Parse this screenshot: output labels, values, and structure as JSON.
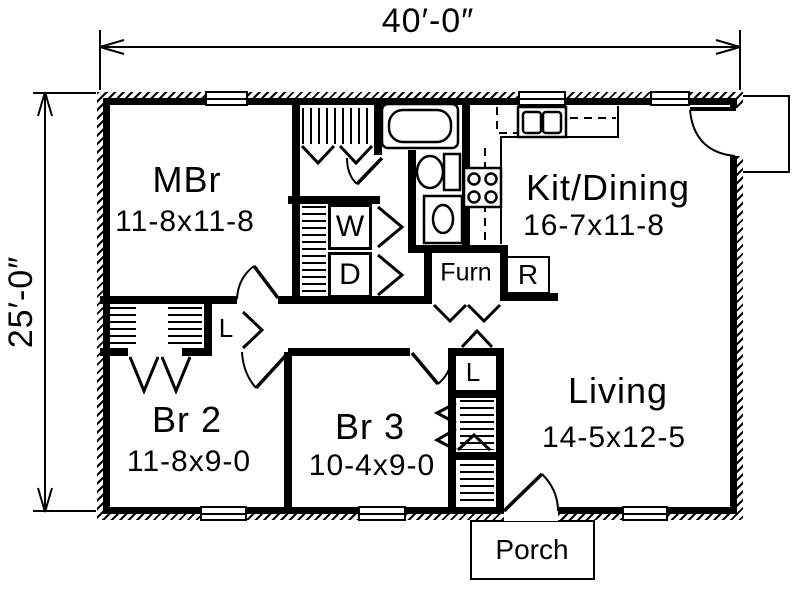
{
  "title": "One-story house floor plan",
  "dimensions": {
    "width_label": "40′-0″",
    "height_label": "25′-0″"
  },
  "rooms": [
    {
      "name": "MBr",
      "size": "11-8x11-8"
    },
    {
      "name": "Kit/Dining",
      "size": "16-7x11-8"
    },
    {
      "name": "Br 2",
      "size": "11-8x9-0"
    },
    {
      "name": "Br 3",
      "size": "10-4x9-0"
    },
    {
      "name": "Living",
      "size": "14-5x12-5"
    }
  ],
  "labels": {
    "washer": "W",
    "dryer": "D",
    "furnace": "Furn",
    "refrigerator": "R",
    "linen_hall": "L",
    "linen_br3": "L",
    "porch": "Porch"
  },
  "colors": {
    "line": "#000000",
    "background": "#ffffff"
  }
}
